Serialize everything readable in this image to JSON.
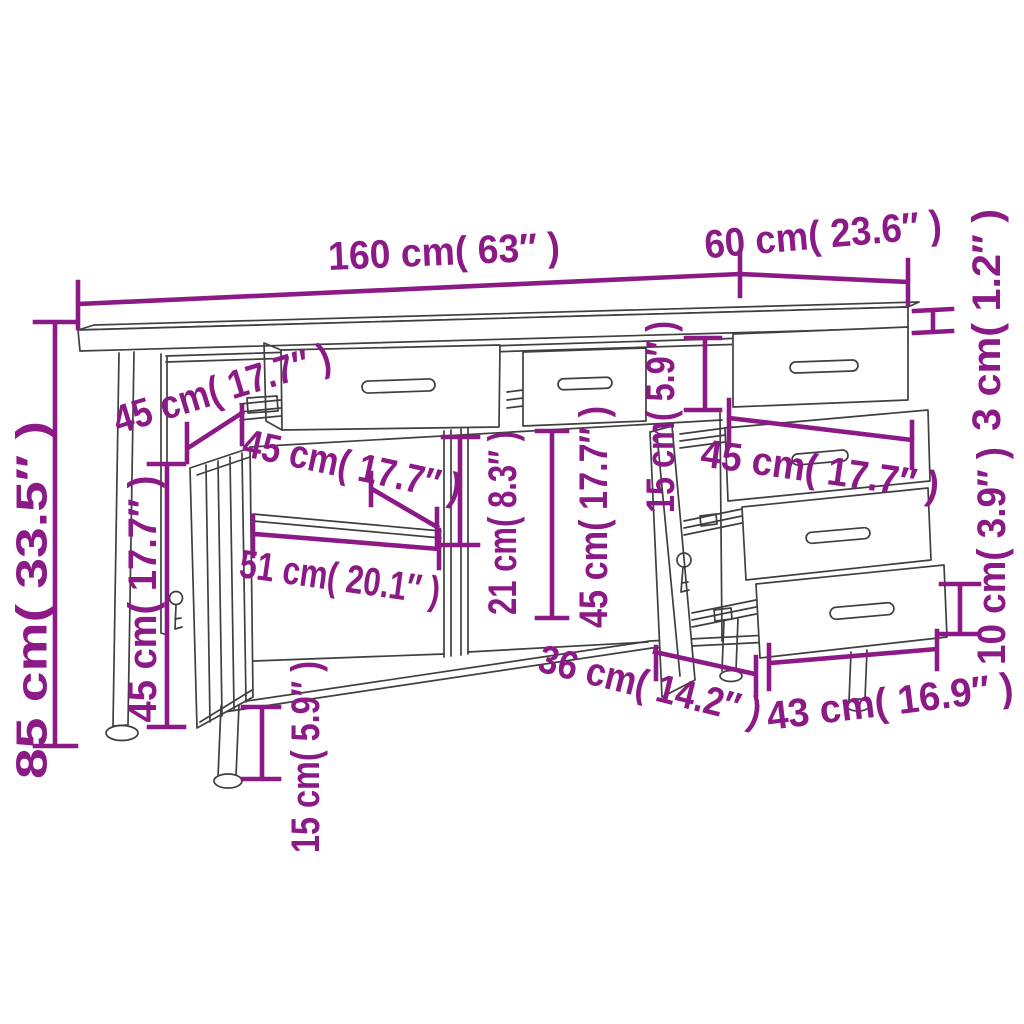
{
  "colors": {
    "annotation": "#8C1A86",
    "furniture_line": "#3F3F3F",
    "background": "#FFFFFF"
  },
  "dimensions": {
    "width_total": {
      "label": "160 cm( 63″ )"
    },
    "depth_top": {
      "label": "60 cm( 23.6″ )"
    },
    "top_thickness": {
      "label": "3 cm( 1.2″ )"
    },
    "height_total": {
      "label": "85 cm( 33.5″ )"
    },
    "drawer_depth_left": {
      "label": "45 cm( 17.7″ )"
    },
    "inner_width_left": {
      "label": "45 cm( 17.7″ )"
    },
    "shelf_width": {
      "label": "51 cm( 20.1″ )"
    },
    "shelf_clearance": {
      "label": "21 cm( 8.3″ )"
    },
    "inner_height_center": {
      "label": "45 cm( 17.7″ )"
    },
    "drawer_front_height_right": {
      "label": "15 cm( 5.9″ )"
    },
    "drawer_width_right": {
      "label": "45 cm( 17.7″ )"
    },
    "drawer_inner_height_right": {
      "label": "10 cm( 3.9″ )"
    },
    "drawer_depth_right": {
      "label": "43 cm( 16.9″ )"
    },
    "base_depth": {
      "label": "36 cm( 14.2″ )"
    },
    "leg_height": {
      "label": "15 cm( 5.9″ )"
    },
    "door_width": {
      "label": "45 cm( 17.7″ )"
    }
  }
}
